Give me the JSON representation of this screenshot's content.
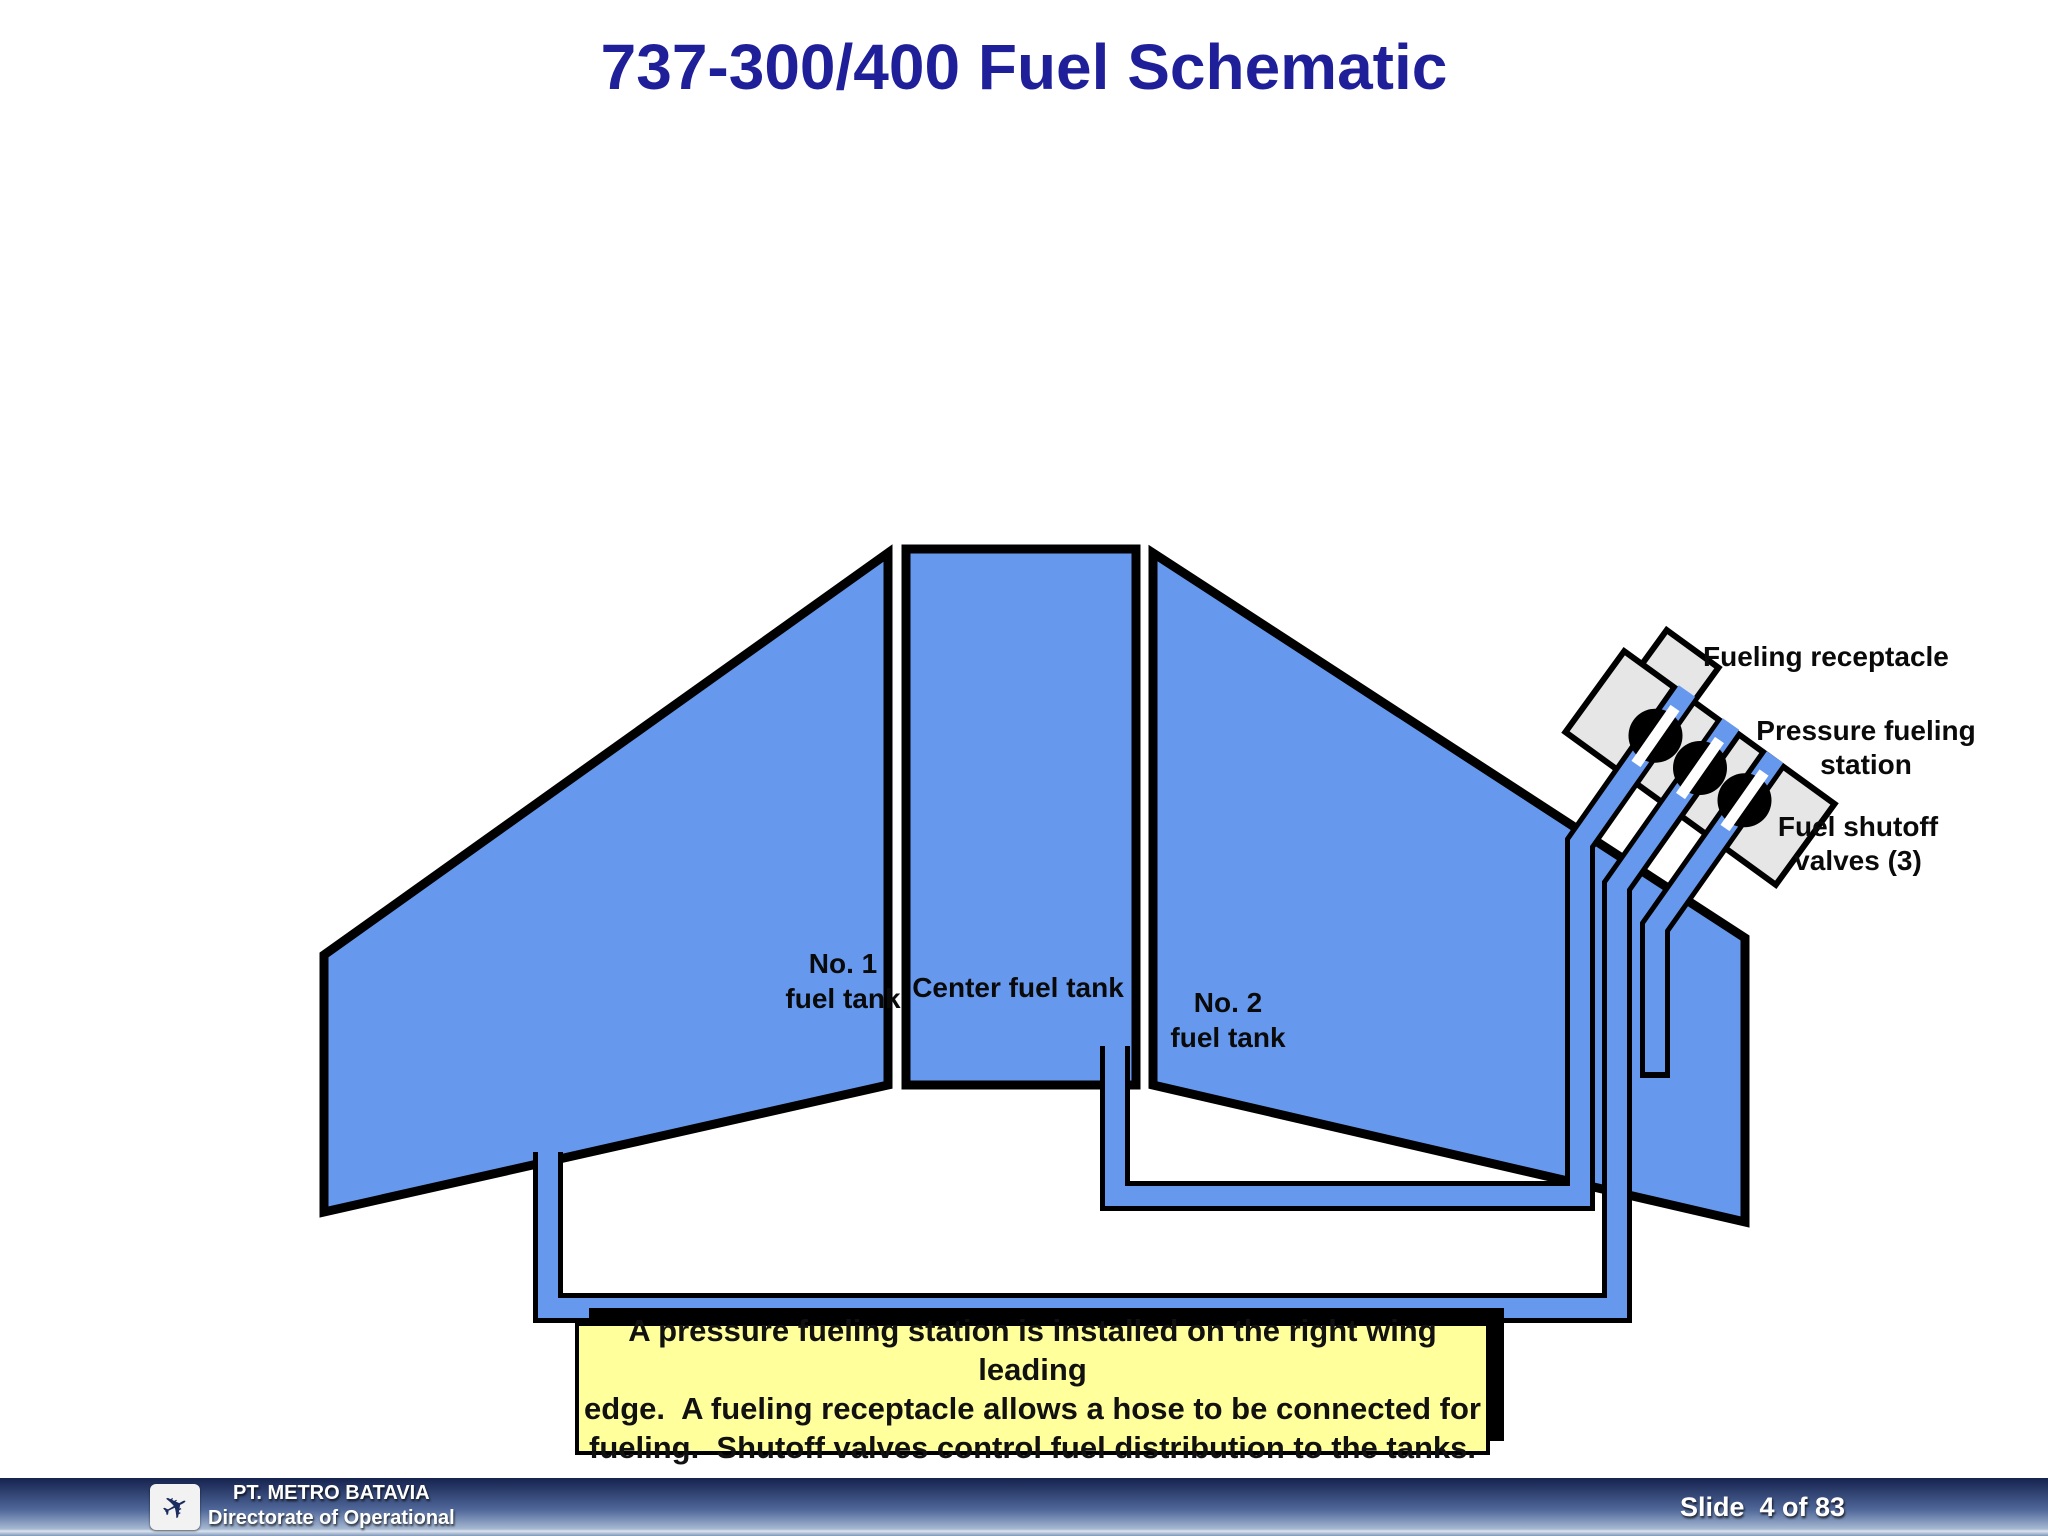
{
  "slide": {
    "title": "737-300/400 Fuel Schematic"
  },
  "colors": {
    "accent_blue": "#6699EE",
    "title_color": "#1F1F99",
    "caption_bg": "#FFFF9B",
    "plate_gray": "#E6E6E6",
    "footer_dark": "#15224E",
    "footer_mid": "#50689A",
    "footer_light": "#A6B8D2",
    "footer_line": "#DCE5F0",
    "footer_bottom": "#7E96B9"
  },
  "labels": {
    "tank1_line1": "No. 1",
    "tank1_line2": "fuel tank",
    "center_tank": "Center fuel tank",
    "tank2_line1": "No. 2",
    "tank2_line2": "fuel tank",
    "receptacle": "Fueling receptacle",
    "pressure_line1": "Pressure fueling",
    "pressure_line2": "station",
    "shutoff_line1": "Fuel shutoff",
    "shutoff_line2": "valves (3)"
  },
  "caption": {
    "line1": "A pressure fueling station is installed on the right wing leading",
    "line2": "edge.  A fueling receptacle allows a hose to be connected for",
    "line3": "fueling.  Shutoff valves control fuel distribution to the tanks."
  },
  "footer": {
    "org_line1": "PT. METRO BATAVIA",
    "org_line2": "Directorate of Operational",
    "slide_number": "Slide  4 of 83"
  }
}
